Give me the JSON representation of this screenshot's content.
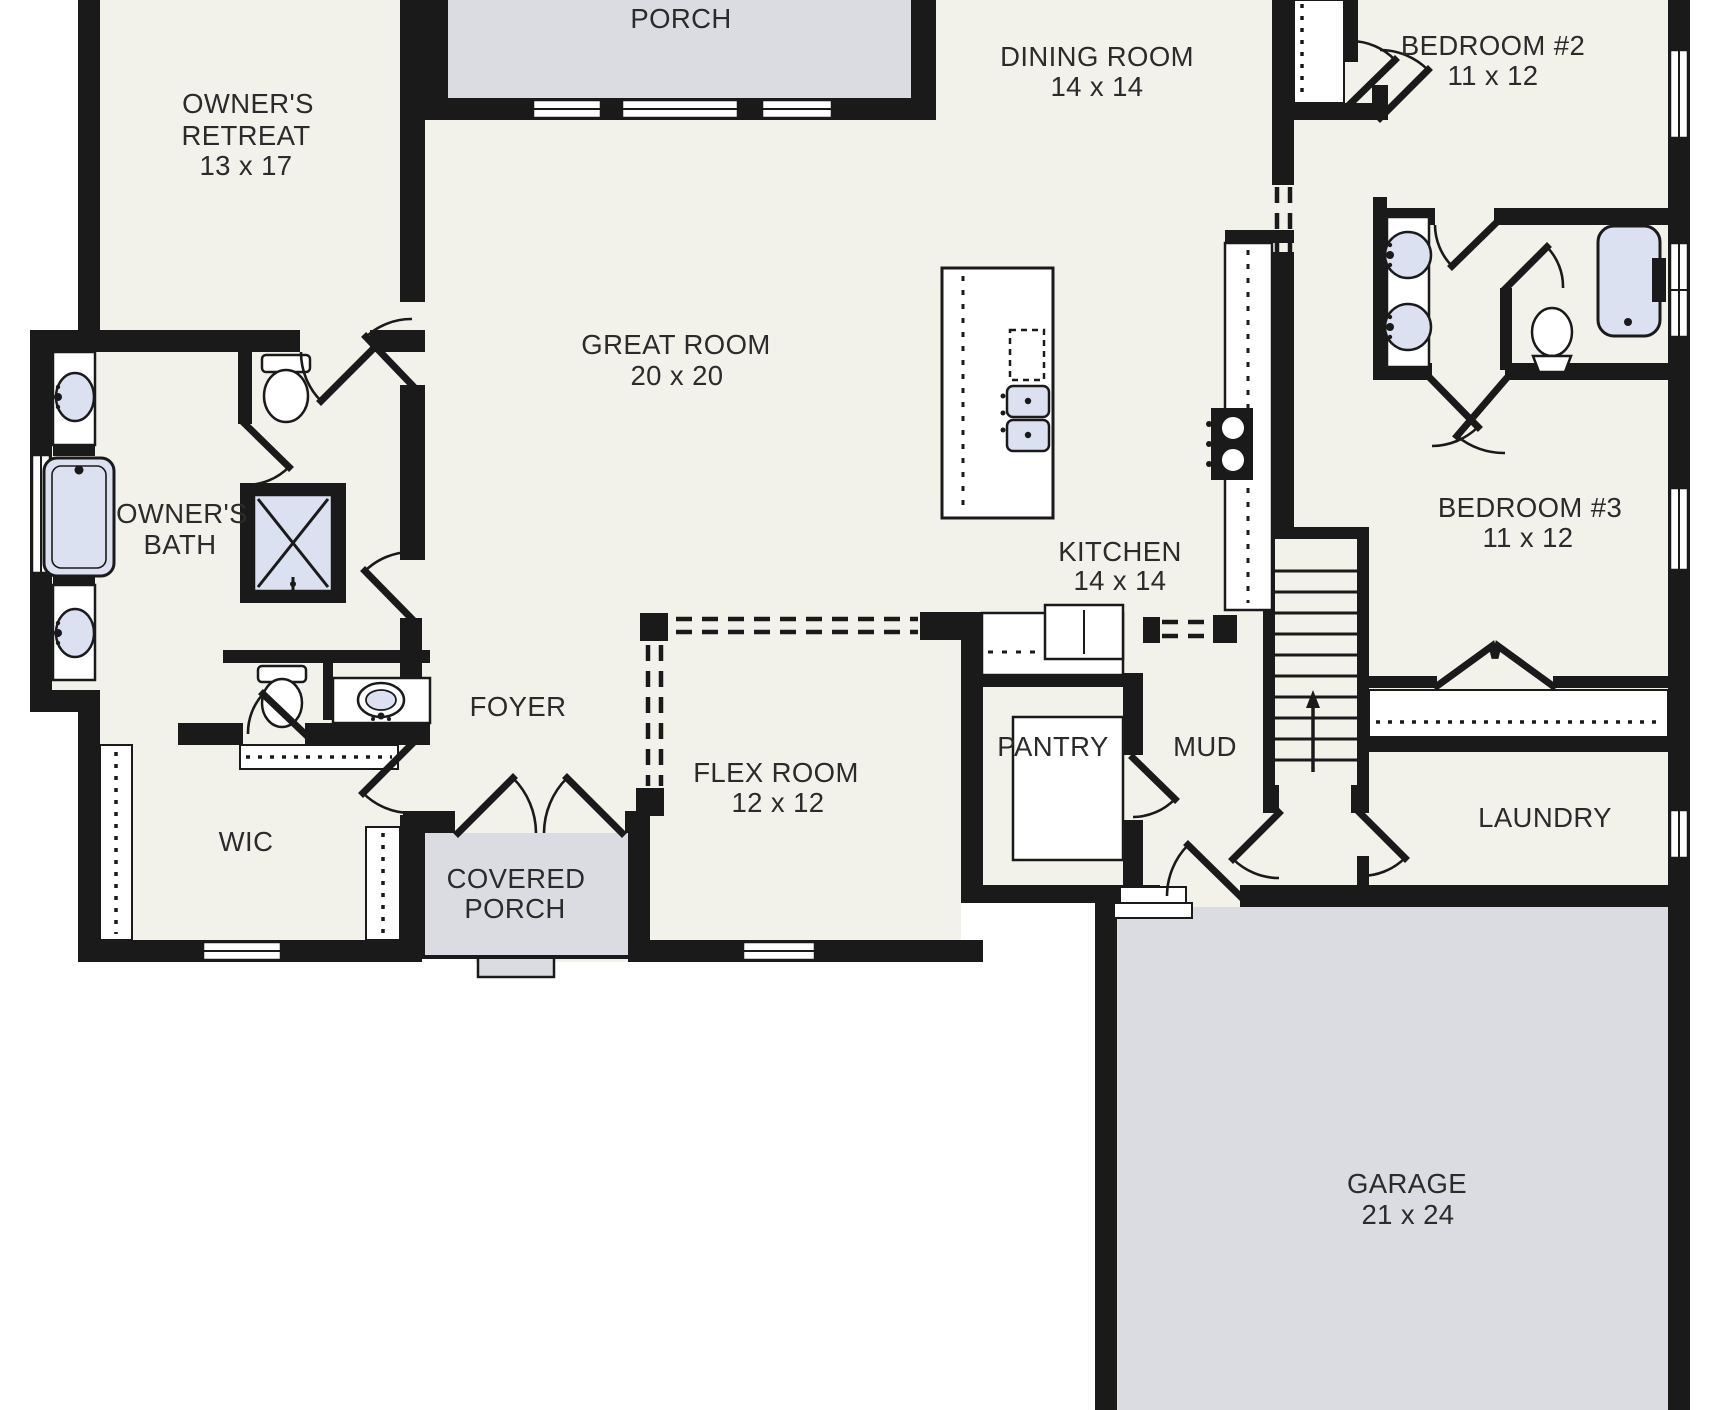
{
  "document": {
    "type": "residential floor plan",
    "floor": "main level"
  },
  "colors": {
    "wall": "#1a1a1a",
    "floor": "#f2f1ea",
    "outdoor_area": "#dbdbe2",
    "plumbing_fixture": "#dce1f1",
    "label_text": "#2b2b2b",
    "background": "#ffffff"
  },
  "rooms": {
    "porch": {
      "name": "PORCH"
    },
    "owners_retreat": {
      "name": "OWNER'S RETREAT",
      "line1": "OWNER'S",
      "line2": "RETREAT",
      "dims": "13 x 17"
    },
    "dining_room": {
      "name": "DINING ROOM",
      "dims": "14 x 14"
    },
    "bedroom_2": {
      "name": "BEDROOM #2",
      "dims": "11 x 12"
    },
    "great_room": {
      "name": "GREAT ROOM",
      "dims": "20 x 20"
    },
    "owners_bath": {
      "name": "OWNER'S BATH",
      "line1": "OWNER'S",
      "line2": "BATH"
    },
    "kitchen": {
      "name": "KITCHEN",
      "dims": "14 x 14"
    },
    "bedroom_3": {
      "name": "BEDROOM #3",
      "dims": "11 x 12"
    },
    "foyer": {
      "name": "FOYER"
    },
    "flex_room": {
      "name": "FLEX ROOM",
      "dims": "12 x 12"
    },
    "pantry": {
      "name": "PANTRY"
    },
    "mud": {
      "name": "MUD"
    },
    "wic": {
      "name": "WIC"
    },
    "covered_porch": {
      "name": "COVERED PORCH",
      "line1": "COVERED",
      "line2": "PORCH"
    },
    "laundry": {
      "name": "LAUNDRY"
    },
    "garage": {
      "name": "GARAGE",
      "dims": "21 x 24"
    }
  }
}
